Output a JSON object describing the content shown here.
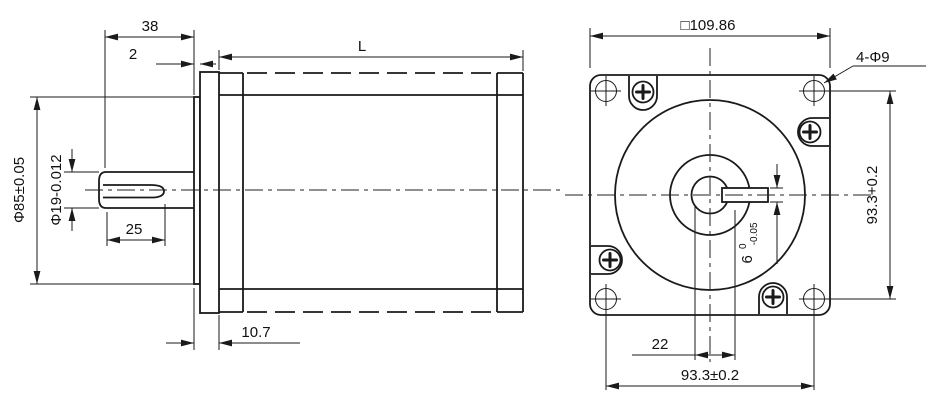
{
  "drawing": {
    "type": "engineering-drawing",
    "subject": "stepper-motor outline, side view and front view",
    "colors": {
      "ink": "#1a1a1a",
      "background": "#ffffff"
    },
    "side_view": {
      "dim_shaft_extension": "38",
      "dim_boss_thickness": "2",
      "dim_body_length": "L",
      "dim_pilot_diameter": "Φ85±0.05",
      "dim_shaft_diameter": "Φ19-0.012",
      "dim_flat_length": "25",
      "dim_flange_thickness": "10.7"
    },
    "front_view": {
      "dim_square_size": "□109.86",
      "dim_mounting_holes": "4-Φ9",
      "dim_hole_spacing_vertical": "93.3+0.2",
      "dim_hole_spacing_horizontal": "93.3±0.2",
      "dim_flat_offset": "22",
      "dim_flat_width": {
        "main": "6",
        "tol_upper": "0",
        "tol_lower": "-0.05"
      }
    }
  }
}
